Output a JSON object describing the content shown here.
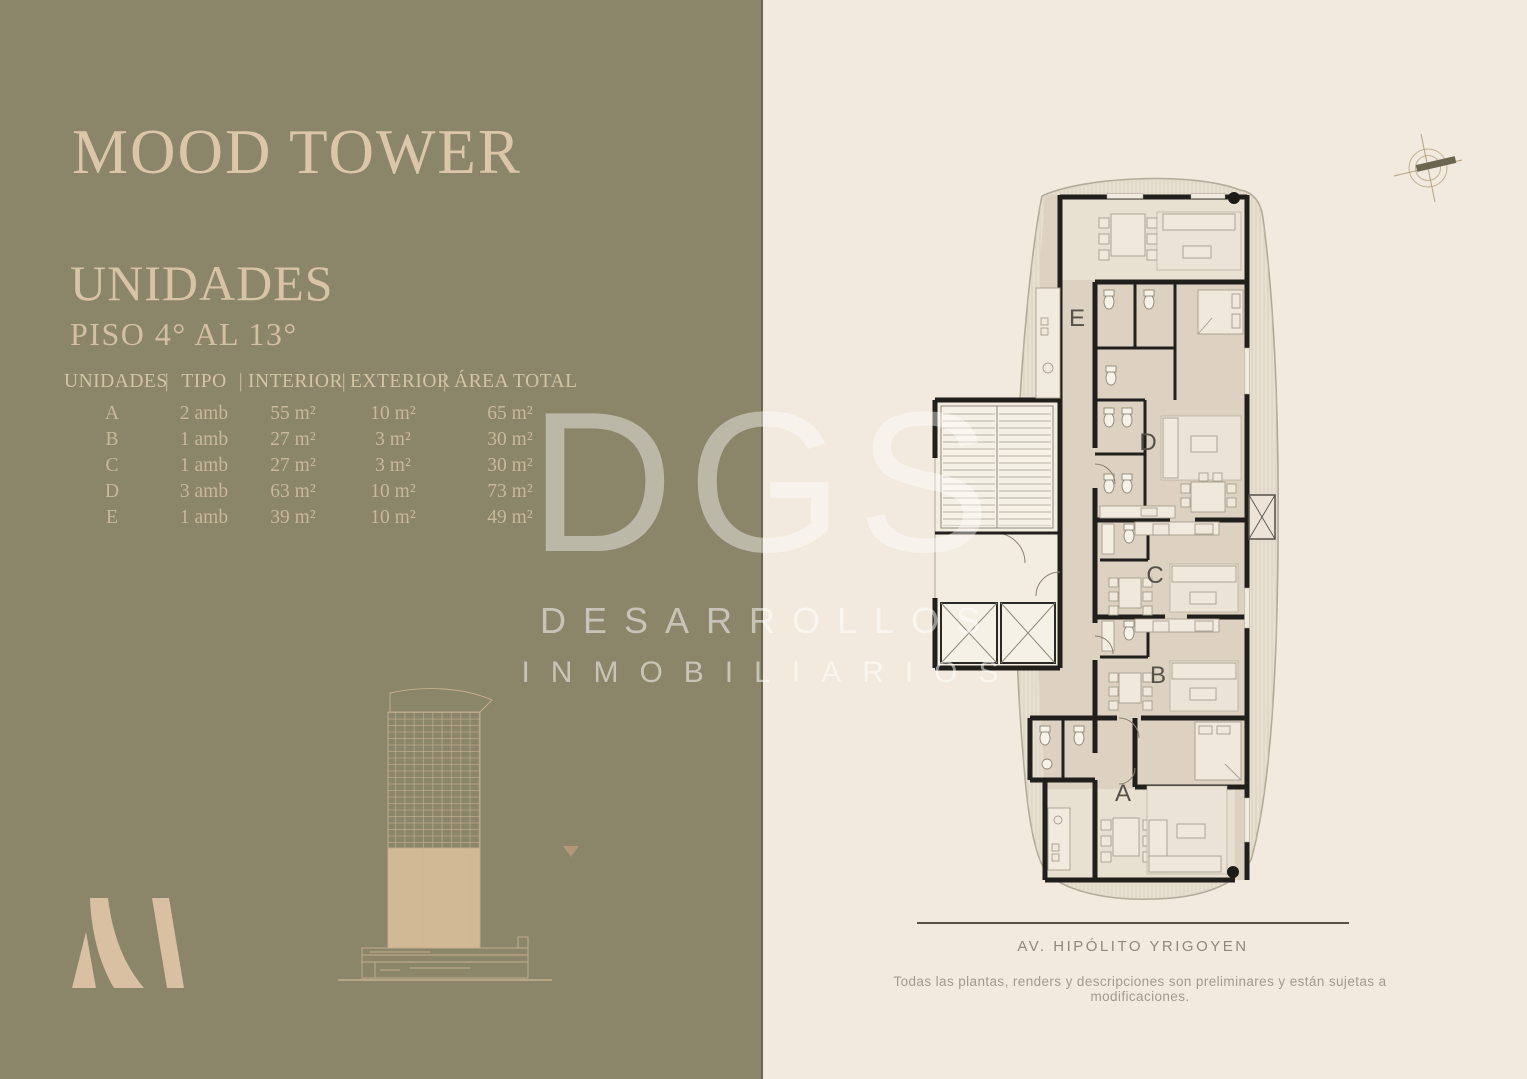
{
  "left_panel": {
    "title": "MOOD TOWER",
    "section_title": "UNIDADES",
    "section_subtitle": "PISO 4° AL 13°",
    "table": {
      "separator": "|",
      "columns": [
        "UNIDADES",
        "TIPO",
        "INTERIOR",
        "EXTERIOR",
        "ÁREA TOTAL"
      ],
      "rows": [
        {
          "unidad": "A",
          "tipo": "2 amb",
          "interior": "55 m²",
          "exterior": "10 m²",
          "area_total": "65 m²"
        },
        {
          "unidad": "B",
          "tipo": "1 amb",
          "interior": "27 m²",
          "exterior": "3 m²",
          "area_total": "30 m²"
        },
        {
          "unidad": "C",
          "tipo": "1 amb",
          "interior": "27 m²",
          "exterior": "3 m²",
          "area_total": "30 m²"
        },
        {
          "unidad": "D",
          "tipo": "3 amb",
          "interior": "63 m²",
          "exterior": "10 m²",
          "area_total": "73 m²"
        },
        {
          "unidad": "E",
          "tipo": "1 amb",
          "interior": "39 m²",
          "exterior": "10 m²",
          "area_total": "49 m²"
        }
      ]
    }
  },
  "watermark": {
    "logo": "DGS",
    "line1": "DESARROLLOS",
    "line2": "INMOBILIARIOS"
  },
  "floor_plan": {
    "units": [
      {
        "label": "E"
      },
      {
        "label": "D"
      },
      {
        "label": "C"
      },
      {
        "label": "B"
      },
      {
        "label": "A"
      }
    ],
    "street": "AV. HIPÓLITO YRIGOYEN"
  },
  "footer": {
    "disclaimer": "Todas las plantas, renders y descripciones son preliminares y están sujetas a modificaciones."
  },
  "colors": {
    "olive_panel": "#8b8569",
    "cream_panel": "#f2eade",
    "title_text": "#dbc6a9",
    "plan_wall": "#211f1b",
    "plan_floor": "#ddd2c2",
    "watermark_white": "#ffffff"
  }
}
